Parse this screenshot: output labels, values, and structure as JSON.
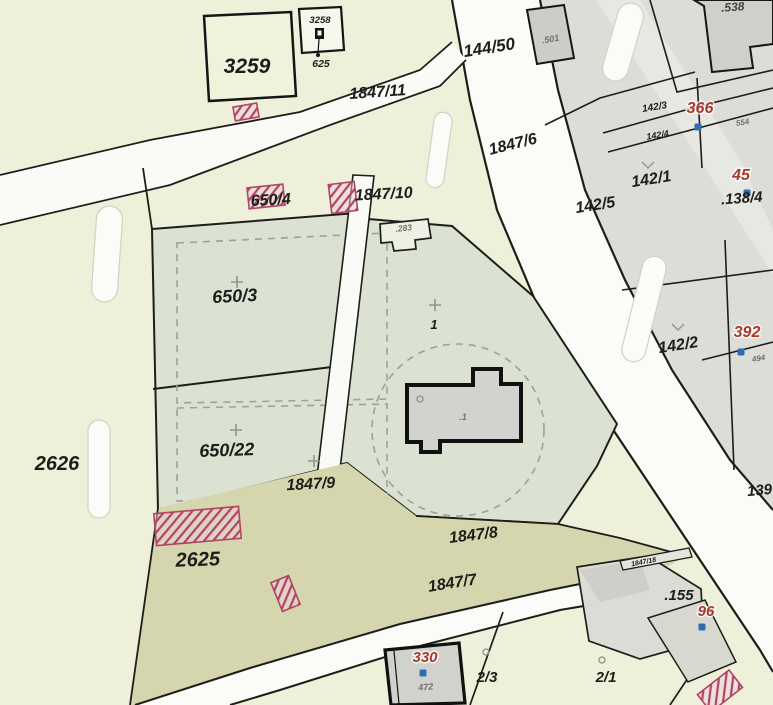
{
  "map": {
    "colors": {
      "pale": "#eef0d9",
      "sage": "#dbe2d1",
      "urban_gray": "#dcddd7",
      "building_gray": "#d2d3ce",
      "dark_building": "#cccdc7",
      "olive": "#d5d6ad",
      "road_white": "#fbfbf7",
      "line_black": "#1d1d1a",
      "dash_green": "#9aa396",
      "red_label": "#a83a2d",
      "blue_dot": "#2e6db4",
      "hatch_stroke": "#af4568",
      "hatch_fill": "#f0cdd8"
    },
    "labels": [
      {
        "text": "3259",
        "x": 247,
        "y": 73,
        "size": 21,
        "color": "black",
        "rot": 0
      },
      {
        "text": "3258",
        "x": 320,
        "y": 23,
        "size": 9.5,
        "color": "black",
        "rot": 0
      },
      {
        "text": "625",
        "x": 321,
        "y": 67,
        "size": 10.5,
        "color": "black",
        "rot": 0
      },
      {
        "text": "1847/11",
        "x": 378,
        "y": 97,
        "size": 16,
        "color": "black",
        "rot": -4
      },
      {
        "text": "144/50",
        "x": 490,
        "y": 53,
        "size": 17,
        "color": "black",
        "rot": -9
      },
      {
        "text": ".501",
        "x": 551,
        "y": 42,
        "size": 9,
        "color": "gray",
        "rot": -10
      },
      {
        "text": ".538",
        "x": 733,
        "y": 11,
        "size": 12,
        "color": "darkgray",
        "rot": -4
      },
      {
        "text": "142/3",
        "x": 655,
        "y": 110,
        "size": 10,
        "color": "black",
        "rot": -9
      },
      {
        "text": "366",
        "x": 700,
        "y": 113,
        "size": 16,
        "color": "red",
        "rot": 0
      },
      {
        "text": "554",
        "x": 743,
        "y": 125,
        "size": 8,
        "color": "gray",
        "rot": -9
      },
      {
        "text": "142/4",
        "x": 658,
        "y": 138,
        "size": 9,
        "color": "black",
        "rot": -9
      },
      {
        "text": "1847/6",
        "x": 514,
        "y": 149,
        "size": 16,
        "color": "black",
        "rot": -14
      },
      {
        "text": "142/5",
        "x": 596,
        "y": 210,
        "size": 16,
        "color": "black",
        "rot": -9
      },
      {
        "text": "142/1",
        "x": 652,
        "y": 184,
        "size": 16,
        "color": "black",
        "rot": -9
      },
      {
        "text": "45",
        "x": 741,
        "y": 180,
        "size": 16,
        "color": "red",
        "rot": 0
      },
      {
        "text": ".138/4",
        "x": 742,
        "y": 203,
        "size": 15,
        "color": "black",
        "rot": -4
      },
      {
        "text": "650/4",
        "x": 271,
        "y": 205,
        "size": 16,
        "color": "black",
        "rot": -3
      },
      {
        "text": "1847/10",
        "x": 384,
        "y": 199,
        "size": 16,
        "color": "black",
        "rot": -3
      },
      {
        "text": ".283",
        "x": 404,
        "y": 231,
        "size": 8.5,
        "color": "gray",
        "rot": -6
      },
      {
        "text": "650/3",
        "x": 235,
        "y": 302,
        "size": 18,
        "color": "black",
        "rot": -3
      },
      {
        "text": "1",
        "x": 434,
        "y": 329,
        "size": 13,
        "color": "black",
        "rot": 0
      },
      {
        "text": "392",
        "x": 747,
        "y": 337,
        "size": 16,
        "color": "red",
        "rot": 0
      },
      {
        "text": "494",
        "x": 759,
        "y": 361,
        "size": 8,
        "color": "gray",
        "rot": -9
      },
      {
        "text": "142/2",
        "x": 679,
        "y": 350,
        "size": 16,
        "color": "black",
        "rot": -9
      },
      {
        "text": "2626",
        "x": 57,
        "y": 470,
        "size": 20,
        "color": "black",
        "rot": 0
      },
      {
        "text": "650/22",
        "x": 227,
        "y": 456,
        "size": 18,
        "color": "black",
        "rot": -2
      },
      {
        "text": "1847/9",
        "x": 311,
        "y": 489,
        "size": 16,
        "color": "black",
        "rot": -3
      },
      {
        "text": ".1",
        "x": 463,
        "y": 420,
        "size": 9,
        "color": "gray",
        "rot": 0
      },
      {
        "text": "2625",
        "x": 198,
        "y": 566,
        "size": 20,
        "color": "black",
        "rot": -2
      },
      {
        "text": "1847/8",
        "x": 474,
        "y": 540,
        "size": 16,
        "color": "black",
        "rot": -7
      },
      {
        "text": "1847/7",
        "x": 453,
        "y": 588,
        "size": 16,
        "color": "black",
        "rot": -9
      },
      {
        "text": "1847/18",
        "x": 644,
        "y": 564,
        "size": 7,
        "color": "black",
        "rot": -11
      },
      {
        "text": ".155",
        "x": 679,
        "y": 600,
        "size": 15,
        "color": "black",
        "rot": 0
      },
      {
        "text": "96",
        "x": 706,
        "y": 616,
        "size": 15,
        "color": "red",
        "rot": 0
      },
      {
        "text": "330",
        "x": 425,
        "y": 662,
        "size": 15,
        "color": "red",
        "rot": 0
      },
      {
        "text": "472",
        "x": 426,
        "y": 690,
        "size": 9,
        "color": "gray",
        "rot": -5
      },
      {
        "text": "2/3",
        "x": 487,
        "y": 682,
        "size": 15,
        "color": "black",
        "rot": 0
      },
      {
        "text": "2/1",
        "x": 606,
        "y": 682,
        "size": 15,
        "color": "black",
        "rot": 0
      },
      {
        "text": "139",
        "x": 760,
        "y": 495,
        "size": 15,
        "color": "black",
        "rot": -5
      }
    ],
    "blue_dots": [
      [
        698,
        127
      ],
      [
        747,
        193
      ],
      [
        741,
        352
      ],
      [
        702,
        627
      ],
      [
        423,
        673
      ]
    ],
    "crosses": [
      [
        237,
        282
      ],
      [
        236,
        430
      ],
      [
        314,
        461
      ],
      [
        435,
        305
      ]
    ],
    "grass_marks": [
      [
        648,
        166
      ],
      [
        678,
        328
      ]
    ],
    "circle_marks": [
      [
        486,
        652
      ],
      [
        602,
        660
      ],
      [
        420,
        399
      ]
    ],
    "hatches": [
      {
        "x": 234,
        "y": 105,
        "w": 24,
        "h": 14,
        "rot": -10
      },
      {
        "x": 248,
        "y": 186,
        "w": 36,
        "h": 21,
        "rot": -6
      },
      {
        "x": 330,
        "y": 183,
        "w": 26,
        "h": 29,
        "rot": -7
      },
      {
        "x": 155,
        "y": 510,
        "w": 85,
        "h": 32,
        "rot": -5
      },
      {
        "x": 276,
        "y": 578,
        "w": 19,
        "h": 31,
        "rot": -22
      },
      {
        "x": 700,
        "y": 680,
        "w": 40,
        "h": 22,
        "rot": -38
      }
    ],
    "symbols": {
      "chapel": {
        "x": 319,
        "y": 33
      }
    }
  }
}
